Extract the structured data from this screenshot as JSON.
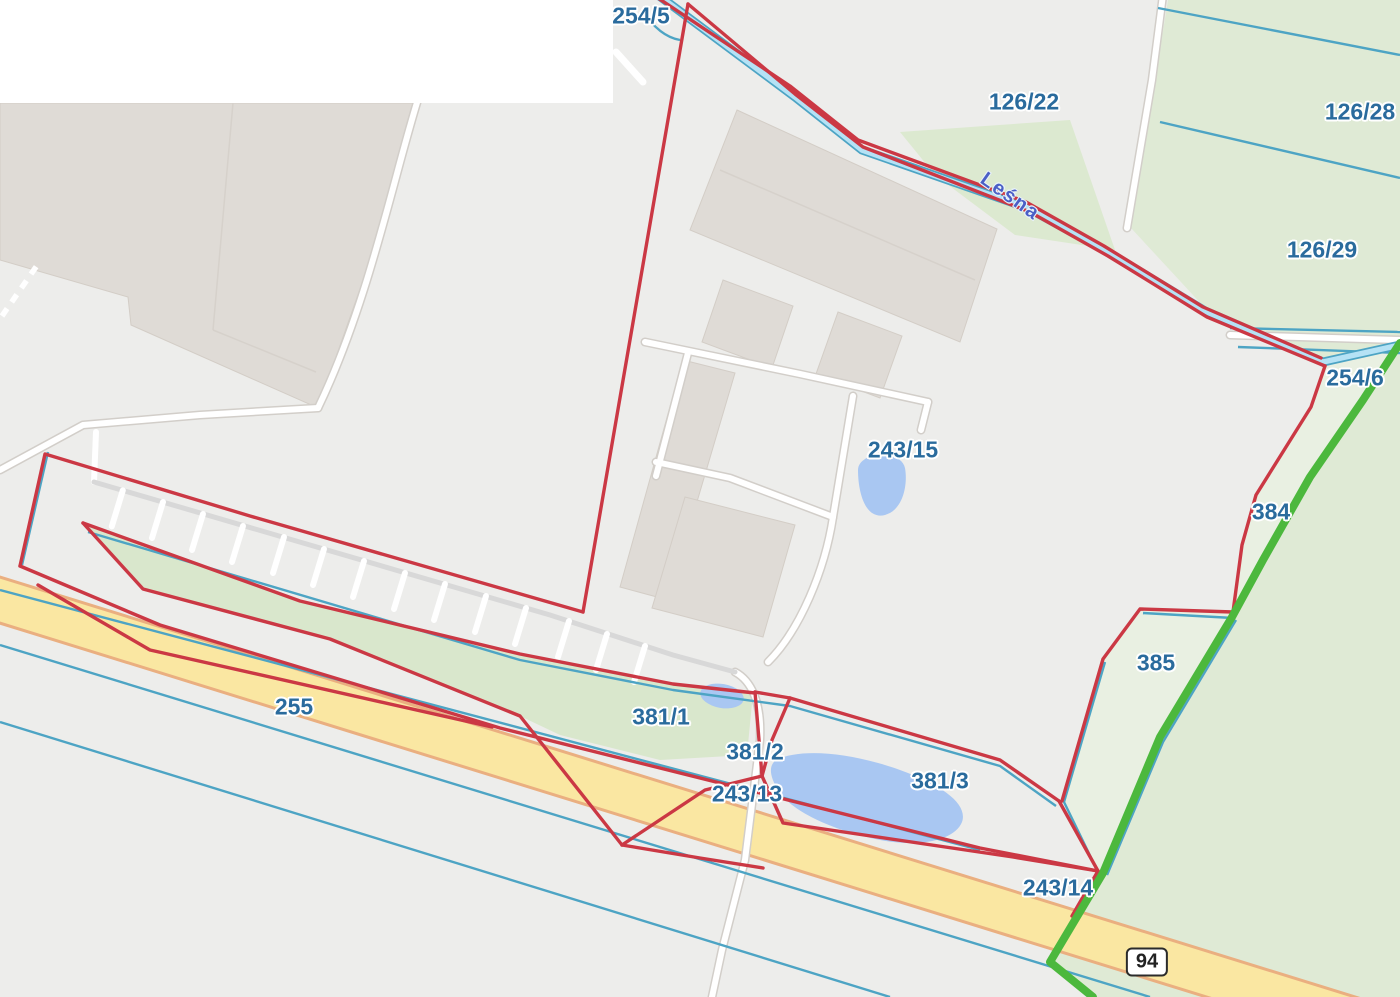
{
  "map": {
    "street_name": "Leśna",
    "road_shield": {
      "text": "94"
    },
    "parcel_labels": [
      {
        "text": "254/5",
        "x": 641,
        "y": 16
      },
      {
        "text": "126/22",
        "x": 1024,
        "y": 102
      },
      {
        "text": "126/28",
        "x": 1360,
        "y": 112
      },
      {
        "text": "126/29",
        "x": 1322,
        "y": 250
      },
      {
        "text": "254/6",
        "x": 1355,
        "y": 378
      },
      {
        "text": "243/15",
        "x": 903,
        "y": 450
      },
      {
        "text": "384",
        "x": 1271,
        "y": 512
      },
      {
        "text": "385",
        "x": 1156,
        "y": 663
      },
      {
        "text": "255",
        "x": 294,
        "y": 707
      },
      {
        "text": "381/1",
        "x": 661,
        "y": 717
      },
      {
        "text": "381/2",
        "x": 755,
        "y": 752
      },
      {
        "text": "243/13",
        "x": 747,
        "y": 794
      },
      {
        "text": "381/3",
        "x": 940,
        "y": 781
      },
      {
        "text": "243/14",
        "x": 1058,
        "y": 888
      }
    ],
    "colors": {
      "boundary_red": "#cb3844",
      "waterline_teal": "#4da4c4",
      "stream_blue": "#b5e2f5",
      "powerline_green": "#4cb83d",
      "field_green": "#dfead5",
      "field_green_light": "#e9f0e2",
      "road_yellow": "#fae7a2",
      "road_yellow_casing": "#eaaf80",
      "building_beige": "#dfdbd6",
      "pond_blue": "#a9c7f2",
      "label_blue": "#2a6b9d",
      "street_label_blue": "#4b5fc6",
      "background_gray": "#ededeb"
    }
  }
}
